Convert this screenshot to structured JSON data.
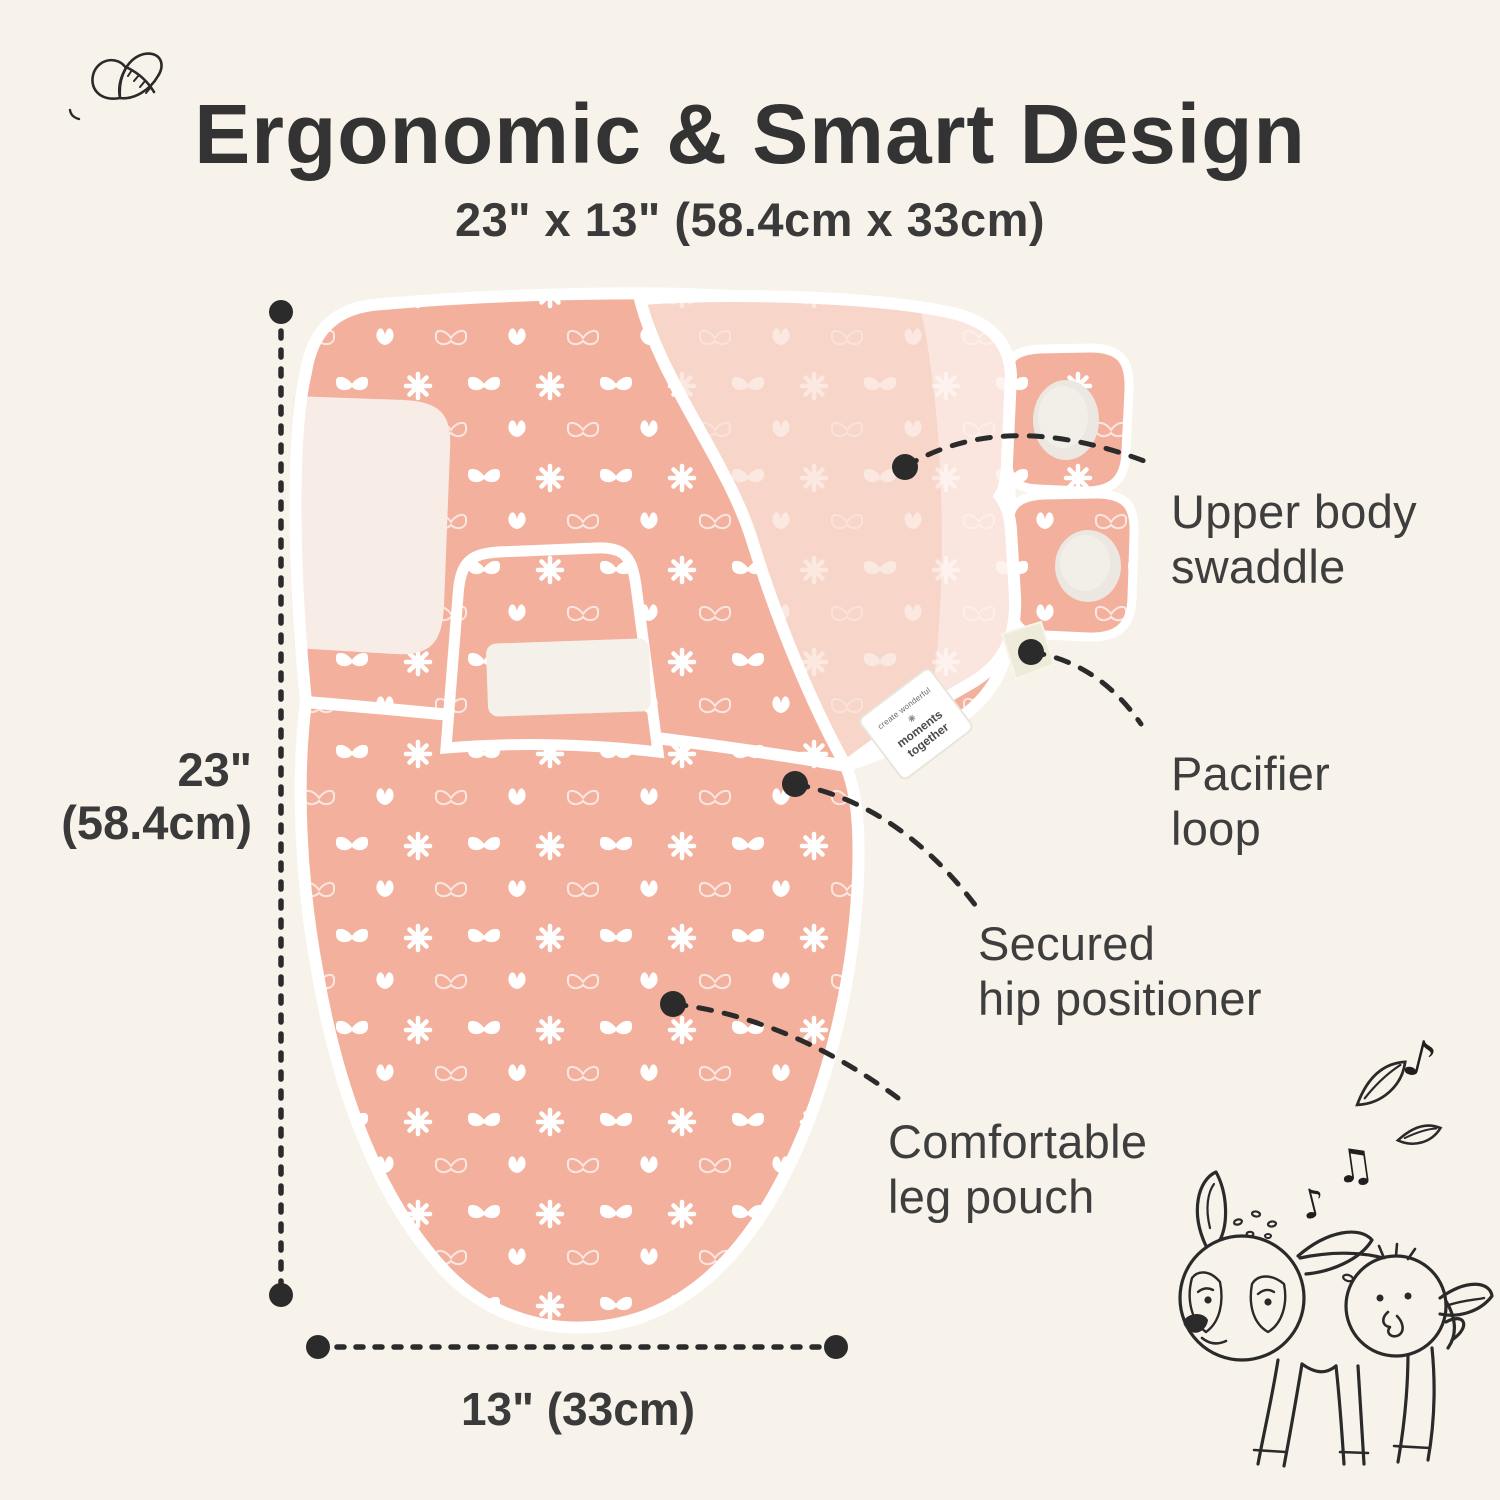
{
  "title": "Ergonomic & Smart Design",
  "subtitle": "23\" x 13\" (58.4cm x 33cm)",
  "dimensions": {
    "height_line1": "23\"",
    "height_line2": "(58.4cm)",
    "width_label": "13\" (33cm)"
  },
  "annotations": [
    {
      "line1": "Upper body",
      "line2": "swaddle"
    },
    {
      "line1": "Pacifier",
      "line2": "loop"
    },
    {
      "line1": "Secured",
      "line2": "hip positioner"
    },
    {
      "line1": "Comfortable",
      "line2": "leg pouch"
    }
  ],
  "brand_tag": {
    "line1": "create wonderful",
    "line2": "moments",
    "line3": "together"
  },
  "colors": {
    "background": "#F8F3EA",
    "fabric": "#F3B09D",
    "fabric_overlay": "#F7D5C9",
    "trim": "#FFFFFF",
    "velcro": "#ECE7E0",
    "inner_lining": "#F8ECE6",
    "tag_cream": "#EFEBDB",
    "ink": "#2B2B2B",
    "text": "#3A3A3A"
  },
  "icons": [
    "butterfly-doodle-icon",
    "deer-and-bird-doodle-icon",
    "music-note-icon",
    "leaf-icon",
    "butterfly-pattern",
    "daisy-pattern"
  ]
}
